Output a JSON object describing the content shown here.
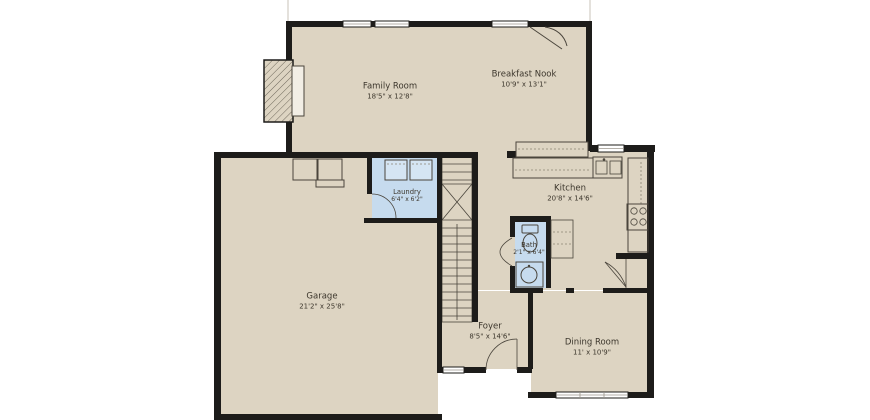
{
  "canvas": {
    "width": 870,
    "height": 420
  },
  "palette": {
    "background": "#ffffff",
    "wall": "#1d1c1a",
    "floor": "#ddd4c2",
    "wet_room": "#c6dbee",
    "line": "#4a453c",
    "label": "#3c362c"
  },
  "floor_plan": {
    "rooms": [
      {
        "id": "family-room",
        "name": "Family Room",
        "dimensions": "18'5\" x 12'8\""
      },
      {
        "id": "breakfast-nook",
        "name": "Breakfast Nook",
        "dimensions": "10'9\" x 13'1\""
      },
      {
        "id": "laundry",
        "name": "Laundry",
        "dimensions": "6'4\" x 6'2\""
      },
      {
        "id": "kitchen",
        "name": "Kitchen",
        "dimensions": "20'8\" x 14'6\""
      },
      {
        "id": "bath",
        "name": "Bath",
        "dimensions": "2'1\" x 6'4\""
      },
      {
        "id": "garage",
        "name": "Garage",
        "dimensions": "21'2\" x 25'8\""
      },
      {
        "id": "foyer",
        "name": "Foyer",
        "dimensions": "8'5\" x 14'6\""
      },
      {
        "id": "dining-room",
        "name": "Dining Room",
        "dimensions": "11' x 10'9\""
      }
    ],
    "fixtures": [
      "fireplace",
      "corner-fireplace",
      "washer-dryer",
      "kitchen-sink",
      "cooktop",
      "toilet",
      "bath-sink",
      "stairs",
      "pantry-shelves"
    ]
  }
}
